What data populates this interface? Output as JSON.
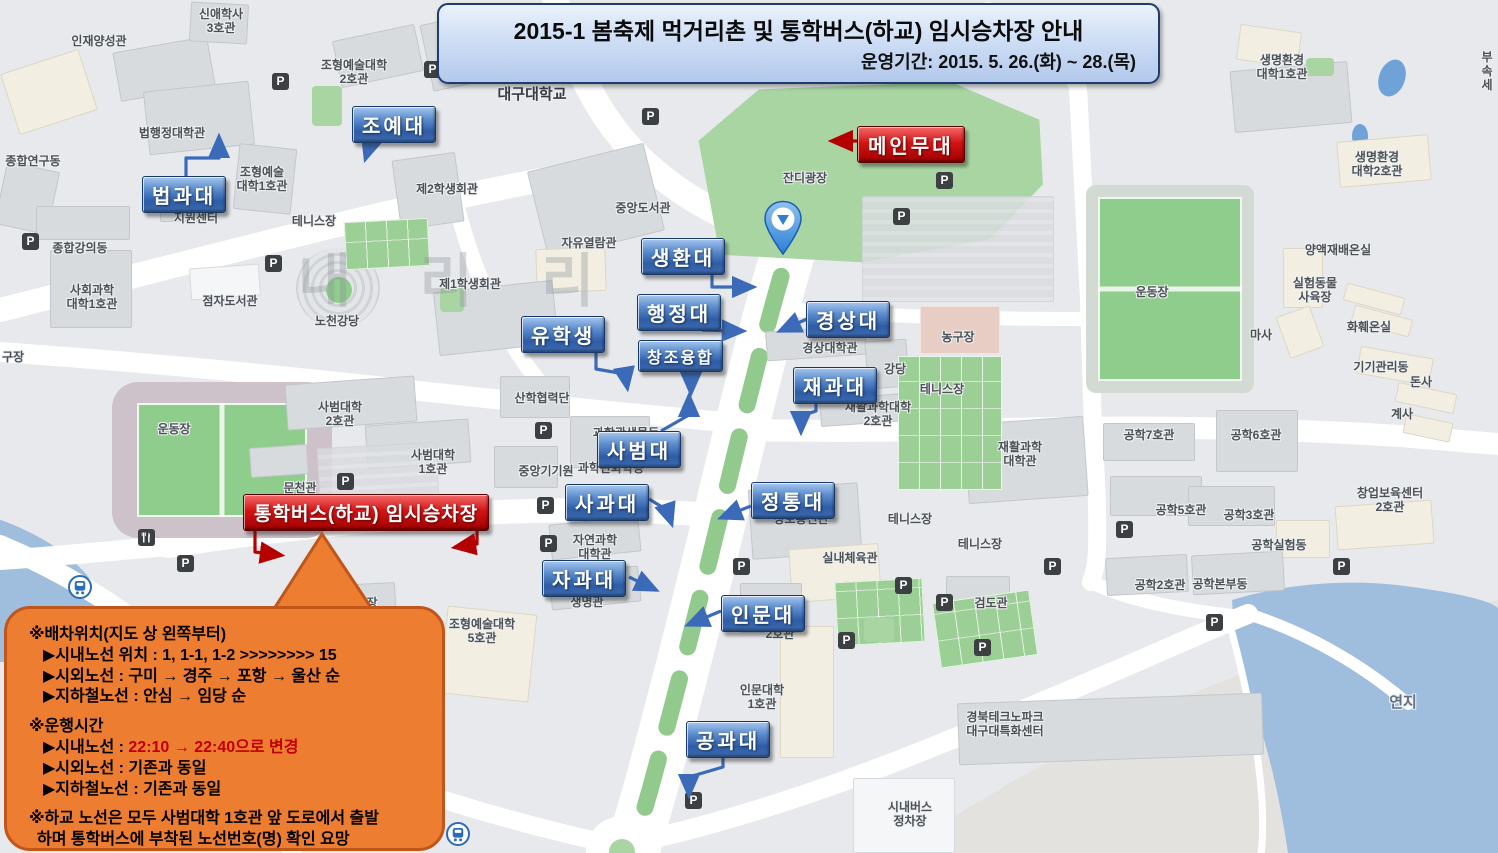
{
  "header": {
    "title": "2015-1 봄축제 먹거리촌 및 통학버스(하교) 임시승차장 안내",
    "period": "운영기간: 2015. 5. 26.(화) ~ 28.(목)"
  },
  "map": {
    "watermark": "내 리 리",
    "texts": [
      {
        "t": "인재양성관",
        "x": 99,
        "y": 34
      },
      {
        "t": "신애학사\n3호관",
        "x": 221,
        "y": 7
      },
      {
        "t": "조형예술대학\n2호관",
        "x": 354,
        "y": 58
      },
      {
        "t": "대구대학교",
        "x": 532,
        "y": 86,
        "size": 15,
        "color": "#393e44"
      },
      {
        "t": "법행정대학관",
        "x": 172,
        "y": 126
      },
      {
        "t": "종합연구동",
        "x": 33,
        "y": 154
      },
      {
        "t": "조형예술\n대학1호관",
        "x": 262,
        "y": 165
      },
      {
        "t": "지원센터",
        "x": 196,
        "y": 211
      },
      {
        "t": "테니스장",
        "x": 314,
        "y": 214
      },
      {
        "t": "제2학생회관",
        "x": 447,
        "y": 182
      },
      {
        "t": "종합강의동",
        "x": 80,
        "y": 241
      },
      {
        "t": "중앙도서관",
        "x": 643,
        "y": 201
      },
      {
        "t": "사회과학\n대학1호관",
        "x": 92,
        "y": 283
      },
      {
        "t": "자유열람관",
        "x": 589,
        "y": 236
      },
      {
        "t": "점자도서관",
        "x": 230,
        "y": 294
      },
      {
        "t": "제1학생회관",
        "x": 470,
        "y": 277
      },
      {
        "t": "노천강당",
        "x": 337,
        "y": 314
      },
      {
        "t": "잔디광장",
        "x": 805,
        "y": 171
      },
      {
        "t": "구장",
        "x": 2,
        "y": 350,
        "align": "left"
      },
      {
        "t": "운동장",
        "x": 174,
        "y": 422
      },
      {
        "t": "사범대학\n2호관",
        "x": 340,
        "y": 400
      },
      {
        "t": "사범대학\n1호관",
        "x": 433,
        "y": 448
      },
      {
        "t": "문천관",
        "x": 300,
        "y": 481
      },
      {
        "t": "산학협력단",
        "x": 542,
        "y": 391
      },
      {
        "t": "중앙기기원",
        "x": 546,
        "y": 464
      },
      {
        "t": "과학관생물동",
        "x": 626,
        "y": 426
      },
      {
        "t": "과학관화학동",
        "x": 611,
        "y": 461
      },
      {
        "t": "경상대학관",
        "x": 830,
        "y": 341
      },
      {
        "t": "강당",
        "x": 895,
        "y": 362
      },
      {
        "t": "농구장",
        "x": 958,
        "y": 330
      },
      {
        "t": "테니스장",
        "x": 942,
        "y": 382
      },
      {
        "t": "재활과학대학\n2호관",
        "x": 878,
        "y": 400
      },
      {
        "t": "재활과학\n대학관",
        "x": 1020,
        "y": 440
      },
      {
        "t": "정보통신관",
        "x": 801,
        "y": 512
      },
      {
        "t": "실내체육관",
        "x": 850,
        "y": 551
      },
      {
        "t": "테니스장",
        "x": 910,
        "y": 512
      },
      {
        "t": "테니스장",
        "x": 980,
        "y": 537
      },
      {
        "t": "검도관",
        "x": 991,
        "y": 596
      },
      {
        "t": "공학7호관",
        "x": 1149,
        "y": 428
      },
      {
        "t": "공학6호관",
        "x": 1256,
        "y": 428
      },
      {
        "t": "공학5호관",
        "x": 1181,
        "y": 503
      },
      {
        "t": "공학3호관",
        "x": 1249,
        "y": 508
      },
      {
        "t": "창업보육센터\n2호관",
        "x": 1390,
        "y": 486
      },
      {
        "t": "공학실험동",
        "x": 1279,
        "y": 538
      },
      {
        "t": "공학2호관",
        "x": 1160,
        "y": 578
      },
      {
        "t": "공학본부동",
        "x": 1220,
        "y": 577
      },
      {
        "t": "공학실험동",
        "x": 1279,
        "y": 538
      },
      {
        "t": "운동장",
        "x": 1152,
        "y": 285
      },
      {
        "t": "실험동물\n사육장",
        "x": 1315,
        "y": 276
      },
      {
        "t": "마사",
        "x": 1261,
        "y": 328
      },
      {
        "t": "화훼온실",
        "x": 1369,
        "y": 320
      },
      {
        "t": "기기관리동",
        "x": 1381,
        "y": 360
      },
      {
        "t": "돈사",
        "x": 1421,
        "y": 375
      },
      {
        "t": "계사",
        "x": 1402,
        "y": 407
      },
      {
        "t": "생명환경\n대학1호관",
        "x": 1282,
        "y": 53
      },
      {
        "t": "생명환경\n대학2호관",
        "x": 1377,
        "y": 150
      },
      {
        "t": "양액재배온실",
        "x": 1338,
        "y": 243
      },
      {
        "t": "부속\n세",
        "x": 1476,
        "y": 50,
        "align": "left"
      },
      {
        "t": "농구장",
        "x": 361,
        "y": 596
      },
      {
        "t": "조형예술대학\n5호관",
        "x": 482,
        "y": 617
      },
      {
        "t": "자연과학\n대학관",
        "x": 595,
        "y": 533
      },
      {
        "t": "생명관",
        "x": 587,
        "y": 595
      },
      {
        "t": "2호관",
        "x": 780,
        "y": 627
      },
      {
        "t": "인문대학\n1호관",
        "x": 762,
        "y": 683
      },
      {
        "t": "경북테크노파크\n대구대특화센터",
        "x": 1005,
        "y": 710
      },
      {
        "t": "시내버스\n정차장",
        "x": 910,
        "y": 800
      },
      {
        "t": "연지",
        "x": 1403,
        "y": 694,
        "size": 15,
        "color": "#5f7089"
      }
    ]
  },
  "labels": {
    "blue": [
      {
        "id": "joye",
        "text": "조예대",
        "x": 352,
        "y": 106
      },
      {
        "id": "beopgwa",
        "text": "법과대",
        "x": 142,
        "y": 176
      },
      {
        "id": "saenghwan",
        "text": "생환대",
        "x": 641,
        "y": 238
      },
      {
        "id": "haengjeong",
        "text": "행정대",
        "x": 637,
        "y": 294
      },
      {
        "id": "gyeongsang",
        "text": "경상대",
        "x": 806,
        "y": 301
      },
      {
        "id": "yuhaksaeng",
        "text": "유학생",
        "x": 521,
        "y": 316
      },
      {
        "id": "changjo",
        "text": "창조융합",
        "x": 638,
        "y": 340,
        "small": true
      },
      {
        "id": "jaegwa",
        "text": "재과대",
        "x": 793,
        "y": 367
      },
      {
        "id": "sabeom",
        "text": "사범대",
        "x": 597,
        "y": 431
      },
      {
        "id": "sagwa",
        "text": "사과대",
        "x": 565,
        "y": 484
      },
      {
        "id": "jeongtong",
        "text": "정통대",
        "x": 751,
        "y": 482
      },
      {
        "id": "jagwa",
        "text": "자과대",
        "x": 542,
        "y": 560
      },
      {
        "id": "inmun",
        "text": "인문대",
        "x": 721,
        "y": 595
      },
      {
        "id": "gonggwa",
        "text": "공과대",
        "x": 686,
        "y": 721
      }
    ],
    "red": [
      {
        "id": "main-stage",
        "text": "메인무대",
        "x": 857,
        "y": 126
      },
      {
        "id": "bus-stop",
        "text": "통학버스(하교) 임시승차장",
        "x": 243,
        "y": 494,
        "wide": true
      }
    ]
  },
  "notice": {
    "sections": [
      {
        "heading": "※배차위치(지도 상 왼쪽부터)",
        "items": [
          "▶시내노선 위치 : 1, 1-1, 1-2 >>>>>>>> 15",
          "▶시외노선 : 구미 → 경주 → 포항 → 울산 순",
          "▶지하철노선 : 안심 → 임당 순"
        ]
      },
      {
        "heading": "※운행시간",
        "items": [
          {
            "prefix": "▶시내노선 : ",
            "highlight": "22:10 → 22:40으로 변경"
          },
          "▶시외노선 : 기존과 동일",
          "▶지하철노선 : 기존과 동일"
        ]
      },
      {
        "heading": "※하교 노선은 모두 사범대학 1호관 앞 도로에서 출발",
        "items": [
          {
            "text": "하며 통학버스에 부착된 노선번호(명) 확인 요망"
          }
        ]
      }
    ]
  },
  "icons": {
    "parking": [
      [
        272,
        73
      ],
      [
        424,
        61
      ],
      [
        642,
        108
      ],
      [
        936,
        172
      ],
      [
        893,
        208
      ],
      [
        22,
        233
      ],
      [
        265,
        255
      ],
      [
        535,
        422
      ],
      [
        337,
        473
      ],
      [
        537,
        497
      ],
      [
        177,
        555
      ],
      [
        540,
        535
      ],
      [
        733,
        558
      ],
      [
        895,
        577
      ],
      [
        936,
        594
      ],
      [
        974,
        639
      ],
      [
        838,
        632
      ],
      [
        685,
        792
      ],
      [
        1116,
        521
      ],
      [
        1333,
        558
      ],
      [
        1206,
        614
      ],
      [
        1044,
        558
      ]
    ],
    "subway": [
      [
        68,
        575
      ],
      [
        446,
        822
      ]
    ],
    "restaurant": [
      [
        138,
        529
      ]
    ]
  },
  "colors": {
    "label_blue": "#2e5ca6",
    "label_red": "#c00000",
    "bubble_orange": "#ed7d31",
    "water": "#9fbedd",
    "grass": "#a9d5a3"
  }
}
